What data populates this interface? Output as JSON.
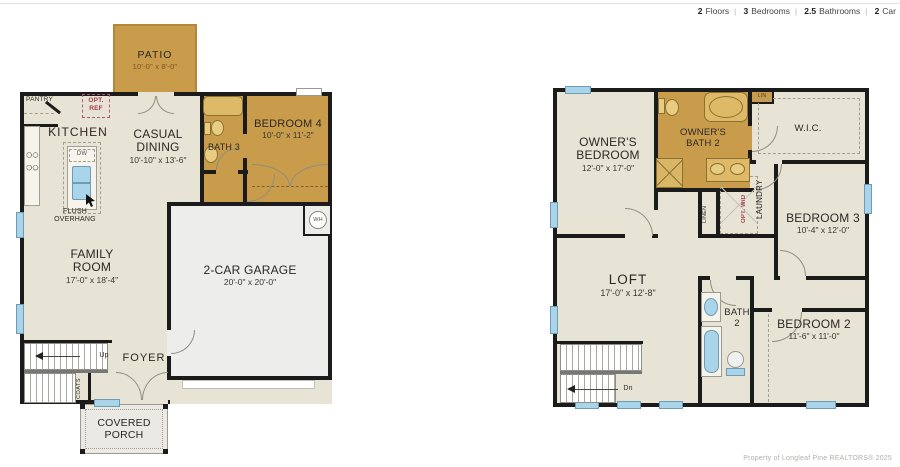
{
  "meta": {
    "separator": "|",
    "items": [
      {
        "value": "2",
        "label": "Floors"
      },
      {
        "value": "3",
        "label": "Bedrooms"
      },
      {
        "value": "2.5",
        "label": "Bathrooms"
      },
      {
        "value": "2",
        "label": "Car"
      }
    ]
  },
  "floor1": {
    "patio": {
      "name": "PATIO",
      "dims": "10'-0\" x 8'-0\""
    },
    "pantry": {
      "name": "PANTRY"
    },
    "opt_ref": {
      "name": "OPT. REF"
    },
    "kitchen": {
      "name": "KITCHEN"
    },
    "dw": {
      "name": "DW"
    },
    "casual_dining": {
      "name": "CASUAL DINING",
      "dims": "10'-10\" x 13'-6\""
    },
    "bath3": {
      "name": "BATH 3"
    },
    "bedroom4": {
      "name": "BEDROOM 4",
      "dims": "10'-0\" x 11'-2\""
    },
    "flush_overhang": {
      "name": "FLUSH OVERHANG"
    },
    "family_room": {
      "name": "FAMILY ROOM",
      "dims": "17'-0\" x 18'-4\""
    },
    "garage": {
      "name": "2-CAR GARAGE",
      "dims": "20'-0\" x 20'-0\""
    },
    "wh": {
      "name": "WH"
    },
    "up": {
      "name": "Up"
    },
    "foyer": {
      "name": "FOYER"
    },
    "coats": {
      "name": "COATS"
    },
    "covered_porch": {
      "name": "COVERED PORCH"
    }
  },
  "floor2": {
    "owners_bedroom": {
      "name": "OWNER'S BEDROOM",
      "dims": "12'-0\" x 17'-0\""
    },
    "owners_bath": {
      "name": "OWNER'S BATH 2"
    },
    "wic": {
      "name": "W.I.C."
    },
    "lin": {
      "name": "LIN"
    },
    "linen": {
      "name": "LINEN"
    },
    "opt_wd": {
      "name": "OPT. W/D"
    },
    "laundry": {
      "name": "LAUNDRY"
    },
    "bedroom3": {
      "name": "BEDROOM 3",
      "dims": "10'-4\" x 12'-0\""
    },
    "loft": {
      "name": "LOFT",
      "dims": "17'-0\" x 12'-8\""
    },
    "bath2": {
      "name": "BATH 2"
    },
    "bedroom2": {
      "name": "BEDROOM 2",
      "dims": "11'-6\" x 11'-0\""
    },
    "dn": {
      "name": "Dn"
    }
  },
  "footer": {
    "copyright": "Property of Longleaf Pine REALTORS®  2025"
  },
  "colors": {
    "tan": "#c89c4b",
    "floor": "#e7e4d5",
    "wall": "#1b1b1b",
    "window": "#a9d4e9",
    "garage": "#ededeb",
    "opt_red": "#a73c4a"
  }
}
